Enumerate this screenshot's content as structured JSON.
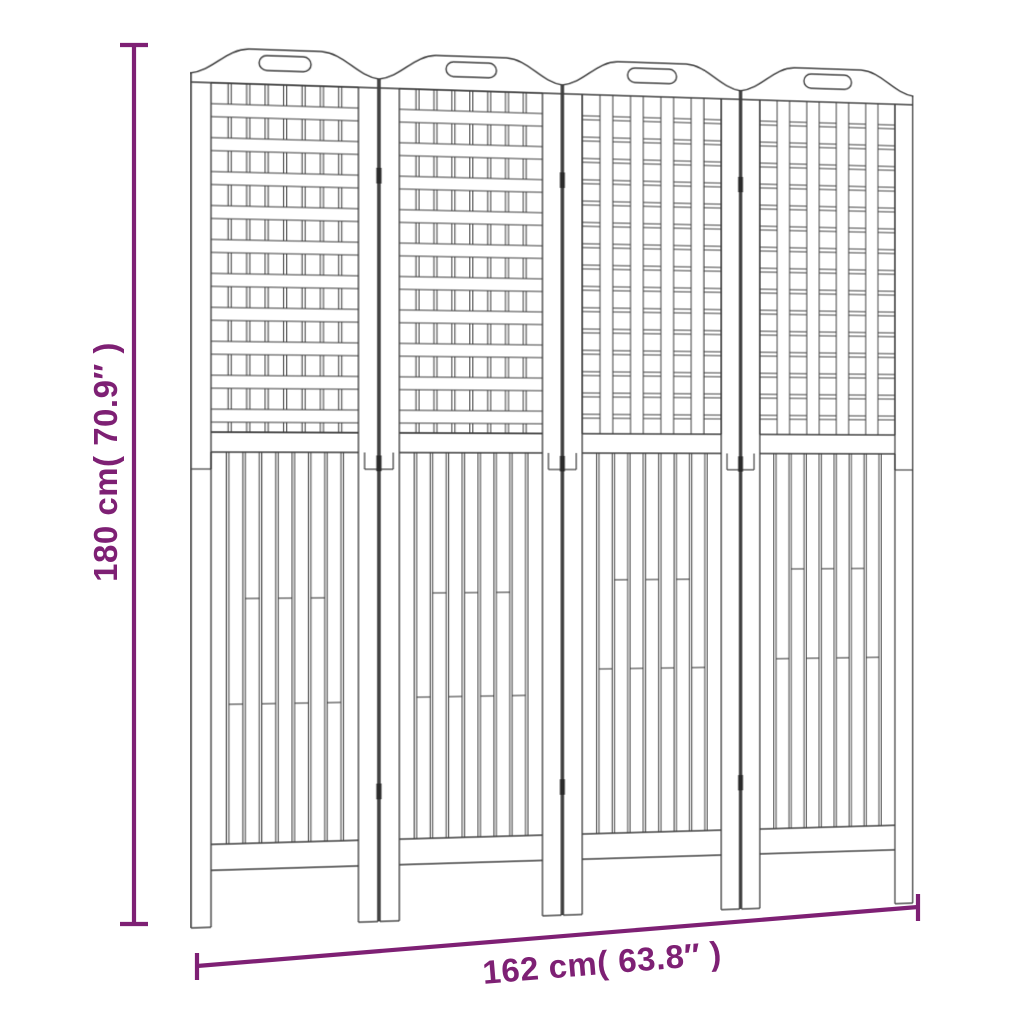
{
  "page": {
    "background": "#ffffff"
  },
  "dimension_annotations": {
    "color": "#7E2074",
    "height": {
      "label": "180 cm( 70.9″ )"
    },
    "width": {
      "label": "162 cm( 63.8″ )"
    }
  },
  "product_drawing": {
    "name": "4-panel wooden room divider",
    "line_color": "#3C3C3C",
    "hinge_color": "#2A2A2A",
    "panel_count": 4,
    "hinge_positions_y": [
      120,
      412,
      745
    ],
    "panels": [
      {
        "lattice_style": "horizontal-weave",
        "slat_joints": {
          "upper_y": 556,
          "lower_y": 662
        }
      },
      {
        "lattice_style": "horizontal-weave",
        "slat_joints": {
          "upper_y": 552,
          "lower_y": 658
        }
      },
      {
        "lattice_style": "vertical-weave",
        "slat_joints": {
          "upper_y": 540,
          "lower_y": 632
        }
      },
      {
        "lattice_style": "vertical-weave",
        "slat_joints": {
          "upper_y": 530,
          "lower_y": 624
        }
      }
    ]
  }
}
